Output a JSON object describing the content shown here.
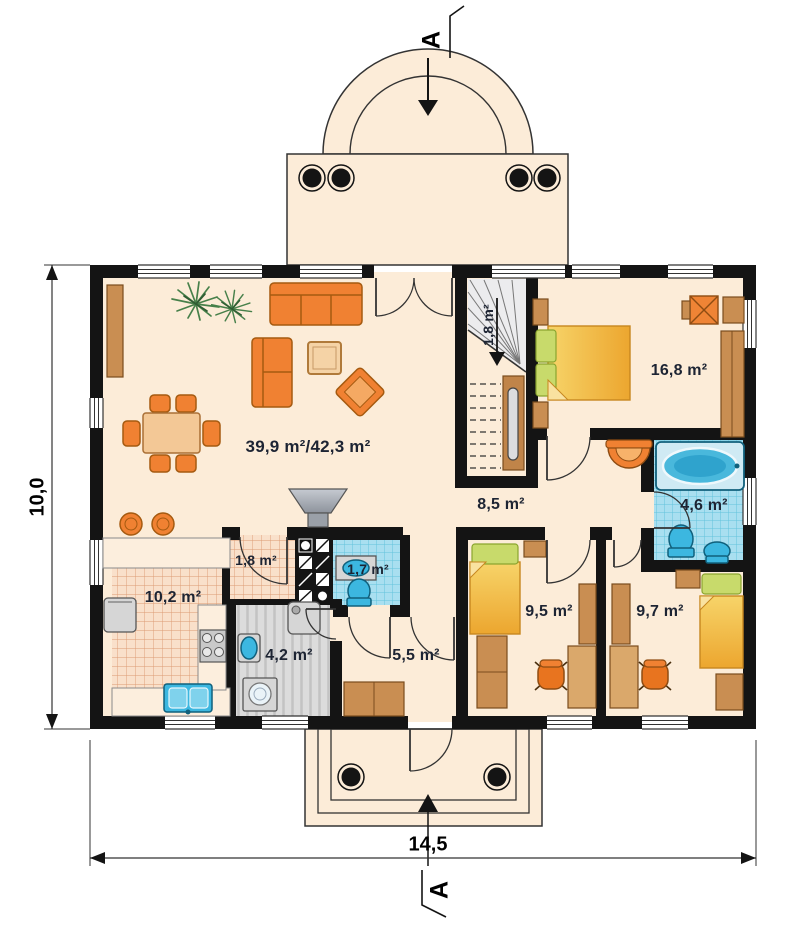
{
  "drawing": {
    "type": "house ground-floor architectural plan",
    "section_marker": "A",
    "dimensions": {
      "width": "14,5",
      "height": "10,0"
    },
    "rooms": {
      "living": "39,9 m²/42,3 m²",
      "kitchen": "10,2 m²",
      "pantry": "1,8 m²",
      "wc": "1,7 m²",
      "utility": "4,2 m²",
      "corridor": "5,5 m²",
      "hall": "8,5 m²",
      "stairs": "1,8 m²",
      "bedroom_main": "16,8 m²",
      "bathroom": "4,6 m²",
      "bedroom_left": "9,5 m²",
      "bedroom_right": "9,7 m²"
    },
    "palette": {
      "wall": "#141414",
      "floor": "#fcecd8",
      "furniture_orange": "#f08132",
      "wood": "#c98e52",
      "tile_blue": "#a9dff0",
      "fixture_blue": "#3cb7e0",
      "bed_yellow": "#f5c954",
      "pillow_green": "#c8da6b",
      "stair_gray": "#ececee"
    }
  }
}
